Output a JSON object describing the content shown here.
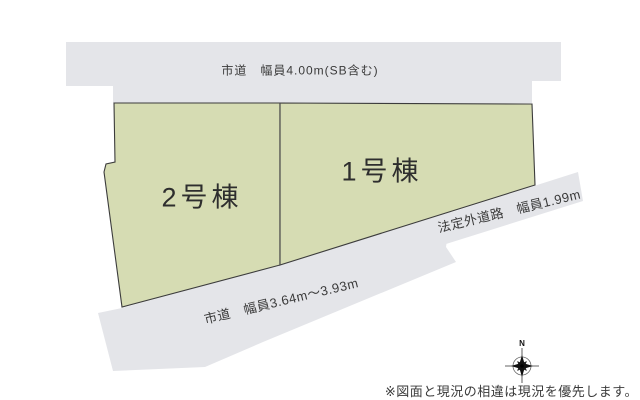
{
  "colors": {
    "plot_fill": "#d6dcb3",
    "road_fill": "#e4e5e9",
    "outline": "#3c3c3c",
    "text": "#3a3a3a"
  },
  "top_road": {
    "label": "市道　幅員4.00m(SB含む)"
  },
  "bottom_road": {
    "label": "市道　幅員3.64m〜3.93m"
  },
  "side_road": {
    "label": "法定外道路　幅員1.99m"
  },
  "plots": {
    "plot1": {
      "label": "1号棟"
    },
    "plot2": {
      "label": "2号棟"
    }
  },
  "compass": {
    "north_label": "N"
  },
  "footer": {
    "disclaimer": "※図面と現況の相違は現況を優先します。"
  }
}
